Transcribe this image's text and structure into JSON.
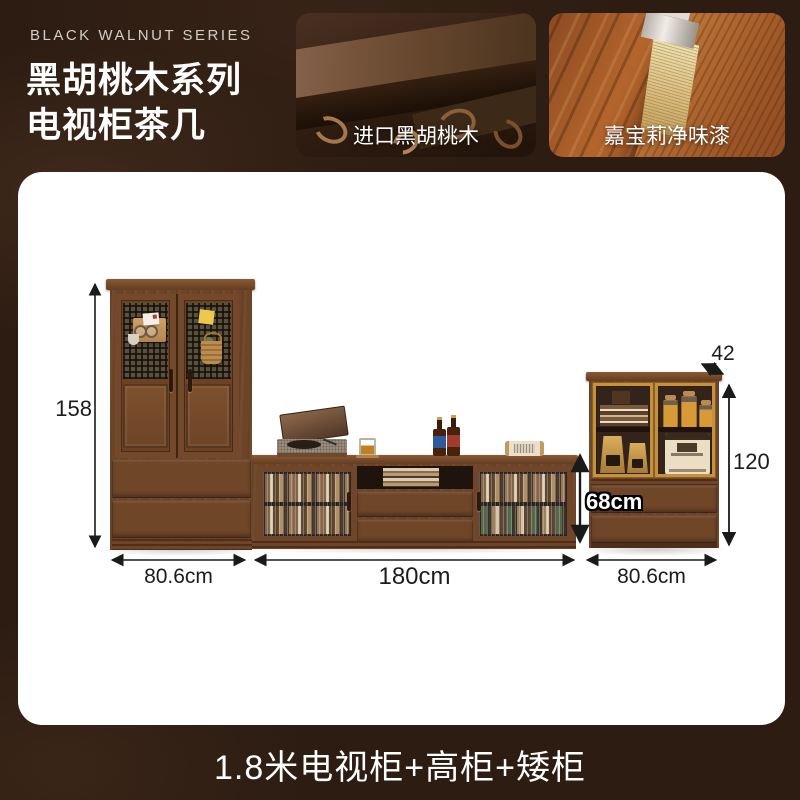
{
  "header": {
    "series_label": "BLACK WALNUT SERIES",
    "title_line1": "黑胡桃木系列",
    "title_line2": "电视柜茶几",
    "photos": [
      {
        "caption": "进口黑胡桃木"
      },
      {
        "caption": "嘉宝莉净味漆"
      }
    ]
  },
  "scene": {
    "dims": {
      "tall_height": "158",
      "tall_width": "80.6cm",
      "tv_width": "180cm",
      "tv_height": "68cm",
      "low_depth": "42",
      "low_height": "120",
      "low_width": "80.6cm"
    }
  },
  "footer": {
    "title": "1.8米电视柜+高柜+矮柜"
  },
  "colors": {
    "background": "#2c1c12",
    "card": "#ffffff",
    "wood": "#6d4427",
    "gold": "#c4923f",
    "dimension_text": "#1c1c1c"
  }
}
